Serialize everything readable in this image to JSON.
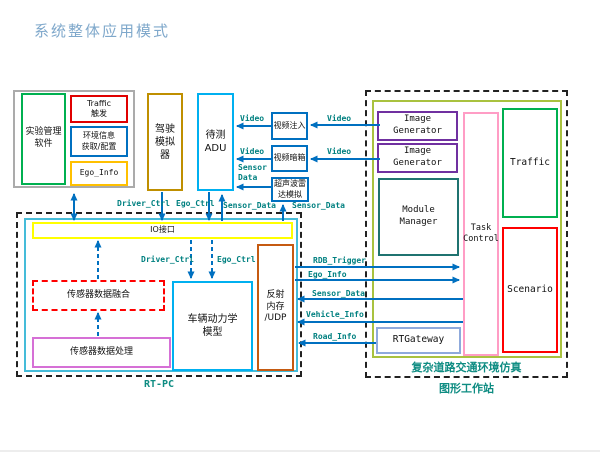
{
  "title": "系统整体应用模式",
  "boxes": {
    "exp_mgmt": "实验管理\n软件",
    "traffic_trigger": "Traffic\n触发",
    "env_info": "环境信息\n获取/配置",
    "ego_info": "Ego_Info",
    "driving_sim": "驾驶\n模拟\n器",
    "adu": "待测\nADU",
    "video_inject": "视频注入",
    "video_darkbox": "视频暗箱",
    "ultrasonic_radar": "超声波雷\n达模拟",
    "image_gen": "Image\nGenerator",
    "module_manager": "Module\nManager",
    "task_control": "Task\nControl",
    "traffic": "Traffic",
    "scenario": "Scenario",
    "rtgateway": "RTGateway",
    "io_interface": "IO接口",
    "sensor_fusion": "传感器数据融合",
    "sensor_processing": "传感器数据处理",
    "vehicle_dynamics": "车辆动力学\n模型",
    "reflective_memory": "反射\n内存\n/UDP"
  },
  "labels": {
    "driver_ctrl": "Driver_Ctrl",
    "ego_ctrl": "Ego_Ctrl",
    "sensor_data": "Sensor_Data",
    "sensor_data_2line": "Sensor\nData",
    "video": "Video",
    "rdb_trigger": "RDB_Trigger",
    "ego_info": "Ego_Info",
    "vehicle_info": "Vehicle_Info",
    "road_info": "Road_Info"
  },
  "captions": {
    "rt_pc": "RT-PC",
    "sim_env": "复杂道路交通环境仿真",
    "workstation": "图形工作站"
  },
  "colors": {
    "arrow_blue": "#0070C0",
    "label_teal": "#008080",
    "title_blue": "#7FA8CB",
    "green": "#00B050",
    "red": "#FF0000",
    "gold": "#FFC000",
    "dark_gold": "#BF8F00",
    "light_blue": "#00B0F0",
    "purple": "#7030A0",
    "dark_teal": "#1F7370",
    "pink": "#FF9DC5",
    "steel_blue": "#8FAADC",
    "orange": "#C55A11",
    "violet": "#D670D6",
    "yellow": "#FFFF00",
    "cyan_frame": "#45BCD9",
    "olive_frame": "#A9C23F",
    "gray_frame": "#ABABAB"
  }
}
